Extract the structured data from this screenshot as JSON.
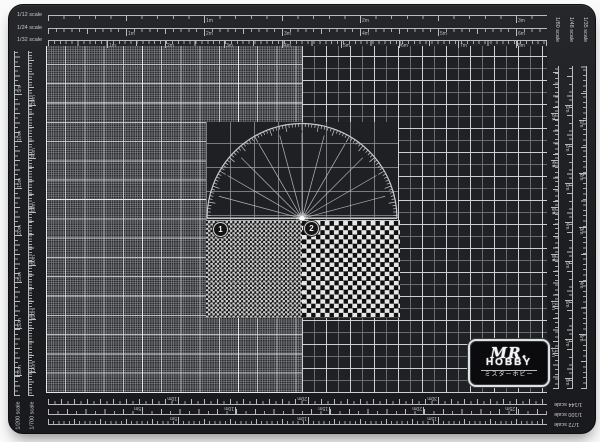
{
  "colors": {
    "mat": "#1d1e21",
    "ruler": "#b9bcbf",
    "label": "#c6c9cc",
    "protractor": "#c6c9cb",
    "hub": "#ffffff"
  },
  "markers": [
    {
      "label": "1"
    },
    {
      "label": "2"
    }
  ],
  "logo": {
    "script": "MR.",
    "name": "HOBBY",
    "katakana": "ミスターホビー"
  },
  "protractor": {
    "radius": 95,
    "radial_step_deg": 15,
    "minor_tick_deg": 2,
    "major_tick_deg": 10
  },
  "rulers": {
    "top": [
      {
        "o": "h",
        "x": 39,
        "y": 10,
        "len": 499,
        "side": 1,
        "minor": 15.6,
        "mid": 78,
        "label": "1/12 scale",
        "lab": "left",
        "flags": [
          [
            195,
            "1m"
          ],
          [
            351,
            "2m"
          ],
          [
            507,
            "3m"
          ]
        ]
      },
      {
        "o": "h",
        "x": 39,
        "y": 23,
        "len": 499,
        "side": 1,
        "minor": 7.8,
        "mid": 39,
        "label": "1/24 scale",
        "lab": "left",
        "flags": [
          [
            117,
            "1m"
          ],
          [
            195,
            "2m"
          ],
          [
            273,
            "3m"
          ],
          [
            351,
            "4m"
          ],
          [
            429,
            "5m"
          ],
          [
            507,
            "6m"
          ]
        ]
      },
      {
        "o": "h",
        "x": 39,
        "y": 35,
        "len": 499,
        "side": 1,
        "minor": 5.9,
        "mid": 29.3,
        "label": "1/32 scale",
        "lab": "left",
        "flags": [
          [
            98,
            "1m"
          ],
          [
            156,
            "2m"
          ],
          [
            215,
            "3m"
          ],
          [
            273,
            "4m"
          ],
          [
            332,
            "5m"
          ],
          [
            390,
            "6m"
          ],
          [
            449,
            "7m"
          ],
          [
            507,
            "8m"
          ]
        ]
      }
    ],
    "right": [
      {
        "o": "v",
        "x": 577,
        "y": 61,
        "len": 323,
        "side": -1,
        "minor": 5.4,
        "mid": 26.8,
        "label": "1/35 scale",
        "lab": "topv",
        "flags": [
          [
            115,
            "1m"
          ],
          [
            168,
            "2m"
          ],
          [
            222,
            "3m"
          ],
          [
            276,
            "4m"
          ],
          [
            329,
            "5m"
          ]
        ]
      },
      {
        "o": "v",
        "x": 563,
        "y": 61,
        "len": 323,
        "side": -1,
        "minor": 7.8,
        "mid": 19.5,
        "label": "1/48 scale",
        "lab": "topv",
        "flags": [
          [
            100,
            "1m"
          ],
          [
            139,
            "2m"
          ],
          [
            178,
            "3m"
          ],
          [
            217,
            "4m"
          ],
          [
            256,
            "5m"
          ],
          [
            295,
            "6m"
          ],
          [
            334,
            "7m"
          ],
          [
            373,
            "8m"
          ]
        ]
      },
      {
        "o": "v",
        "x": 549,
        "y": 61,
        "len": 323,
        "side": -1,
        "minor": 4.7,
        "mid": 11.7,
        "label": "1/80 scale",
        "lab": "topv",
        "flags": [
          [
            108,
            "2m"
          ],
          [
            155,
            "4m"
          ],
          [
            202,
            "6m"
          ],
          [
            249,
            "8m"
          ],
          [
            296,
            "10m"
          ],
          [
            343,
            "12m"
          ]
        ]
      }
    ],
    "bottom": [
      {
        "o": "h",
        "x": 39,
        "y": 399,
        "len": 499,
        "side": -1,
        "minor": 6.5,
        "mid": 13,
        "label": "1/144 scale",
        "lab": "rot180",
        "flags": [
          [
            169,
            "10m"
          ],
          [
            299,
            "20m"
          ],
          [
            429,
            "30m"
          ]
        ]
      },
      {
        "o": "h",
        "x": 39,
        "y": 409,
        "len": 499,
        "side": -1,
        "minor": 9.4,
        "mid": 18.8,
        "label": "1/100 scale",
        "lab": "rot180",
        "flags": [
          [
            133,
            "5m"
          ],
          [
            226,
            "10m"
          ],
          [
            320,
            "15m"
          ],
          [
            414,
            "20m"
          ],
          [
            507,
            "25m"
          ]
        ]
      },
      {
        "o": "h",
        "x": 39,
        "y": 419,
        "len": 499,
        "side": -1,
        "minor": 5.2,
        "mid": 26,
        "label": "1/72 scale",
        "lab": "rot180",
        "flags": [
          [
            169,
            "5m"
          ],
          [
            299,
            "10m"
          ],
          [
            429,
            "15m"
          ]
        ]
      }
    ],
    "left": [
      {
        "o": "v",
        "x": 5,
        "y": 46,
        "len": 345,
        "side": 1,
        "minor": 4.7,
        "mid": 9.4,
        "label": "1/200 scale",
        "lab": "botv",
        "flags": [
          [
            89,
            "5m"
          ],
          [
            136,
            "10m"
          ],
          [
            183,
            "15m"
          ],
          [
            230,
            "20m"
          ],
          [
            277,
            "25m"
          ],
          [
            323,
            "30m"
          ],
          [
            370,
            "35m"
          ]
        ]
      },
      {
        "o": "v",
        "x": 19,
        "y": 46,
        "len": 345,
        "side": 1,
        "minor": 2.7,
        "mid": 13.4,
        "label": "1/700 scale",
        "lab": "botv",
        "flags": [
          [
            100,
            "20m"
          ],
          [
            153,
            "40m"
          ],
          [
            207,
            "60m"
          ],
          [
            260,
            "80m"
          ],
          [
            314,
            "100m"
          ],
          [
            367,
            "120m"
          ]
        ]
      }
    ]
  }
}
